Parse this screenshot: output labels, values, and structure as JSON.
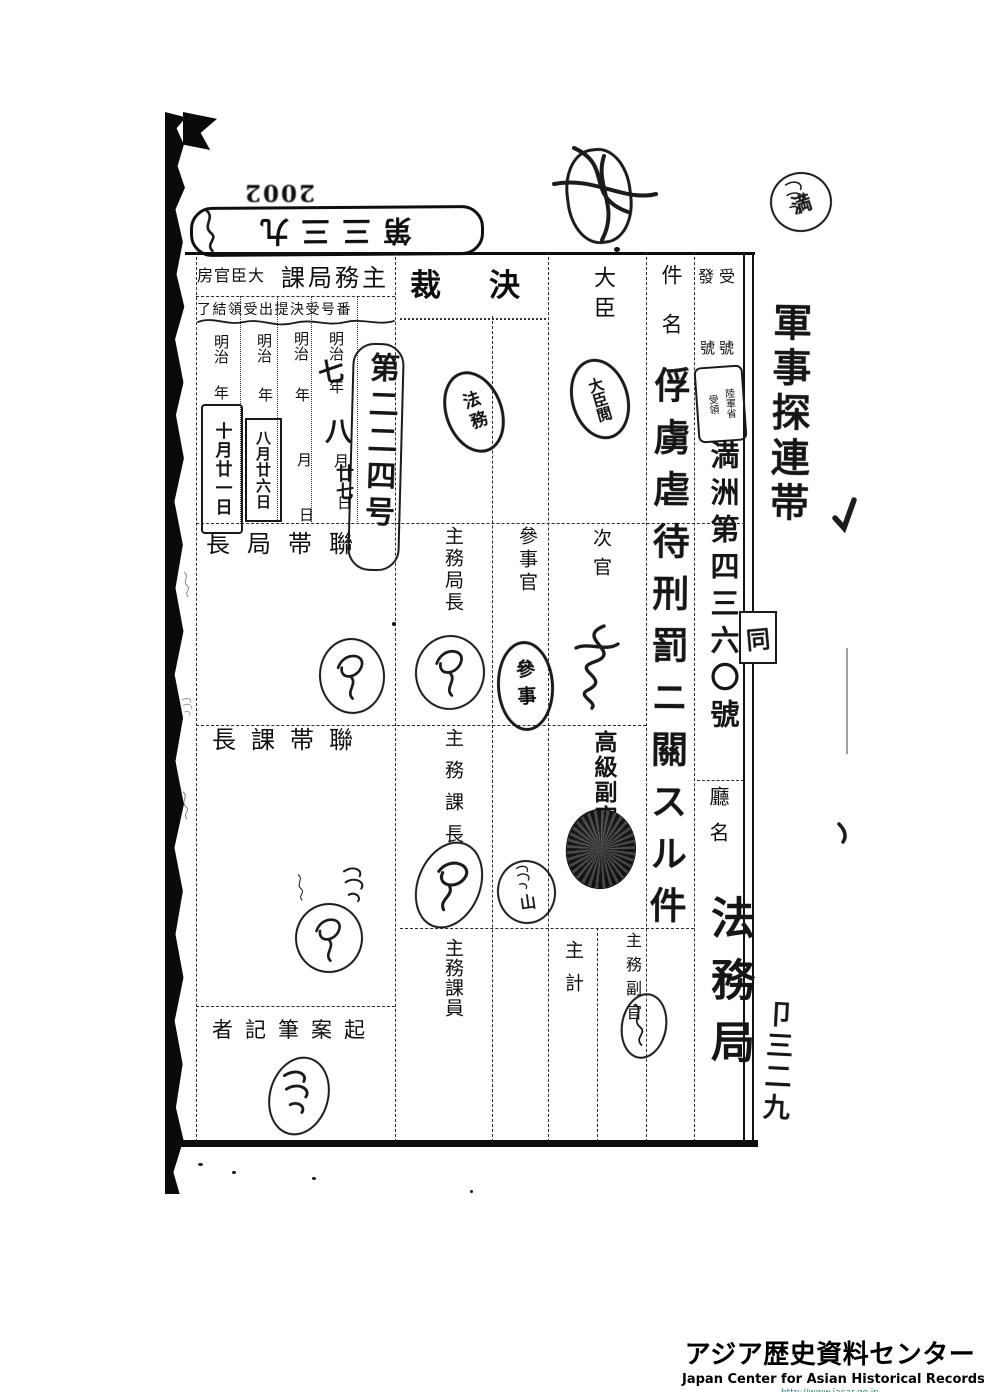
{
  "page_marks": {
    "archive_number": "2002",
    "doc_number_stamp": "第三三九",
    "margin_note_right": "軍事探連帯",
    "margin_note_bottom": "卩三二九",
    "linked_mark": "同"
  },
  "table": {
    "kessai_header": "決裁",
    "group_left": "主務局課",
    "group_right": "大臣官房",
    "sub_headers": "番号受決提出受領結了",
    "uke_hatsu": "受發",
    "gogo": "號號",
    "kenmei": "件名",
    "chomei": "廳名",
    "daijin": "大臣",
    "jikan": "次官",
    "sanjikan": "參事官",
    "shomu_kyokucho": "主務局長",
    "shomu_kacho": "主務課長",
    "shomu_kain": "主務課員",
    "shukei": "主計",
    "shomu_fukukan": "主務副官",
    "kokyu_fukukan": "高級副官",
    "rentai_kyokucho": "聯帯局長",
    "rentai_kacho": "聯帯課長",
    "kian_hikkisha": "起案筆記者"
  },
  "dates": {
    "era": "明治",
    "year": "年",
    "month": "月",
    "day": "日",
    "hand_year": "七",
    "hand_month": "八",
    "hand_day": "廿七",
    "received_box": "八月廿六日",
    "completed_box": "十月廿一日",
    "case_number": "第二二四号"
  },
  "handwritten": {
    "subject": "俘虜虐待刑罰ニ關スル件",
    "receipt_number": "満洲第四三六〇號",
    "office_name": "法務局"
  },
  "seals": {
    "homu": "法務",
    "sanji": "參事",
    "daijin_etsu": "大臣閲",
    "rikugunsho_col1": "陸軍省",
    "rikugunsho_col2": "受領",
    "yama": "山",
    "top_round": "満"
  },
  "footer": {
    "title_jp": "アジア歴史資料センター",
    "title_en": "Japan Center for Asian Historical Records",
    "url": "http://www.jacar.go.jp"
  },
  "colors": {
    "ink": "#111111",
    "url_teal": "#2f7f7f",
    "paper": "#ffffff"
  }
}
